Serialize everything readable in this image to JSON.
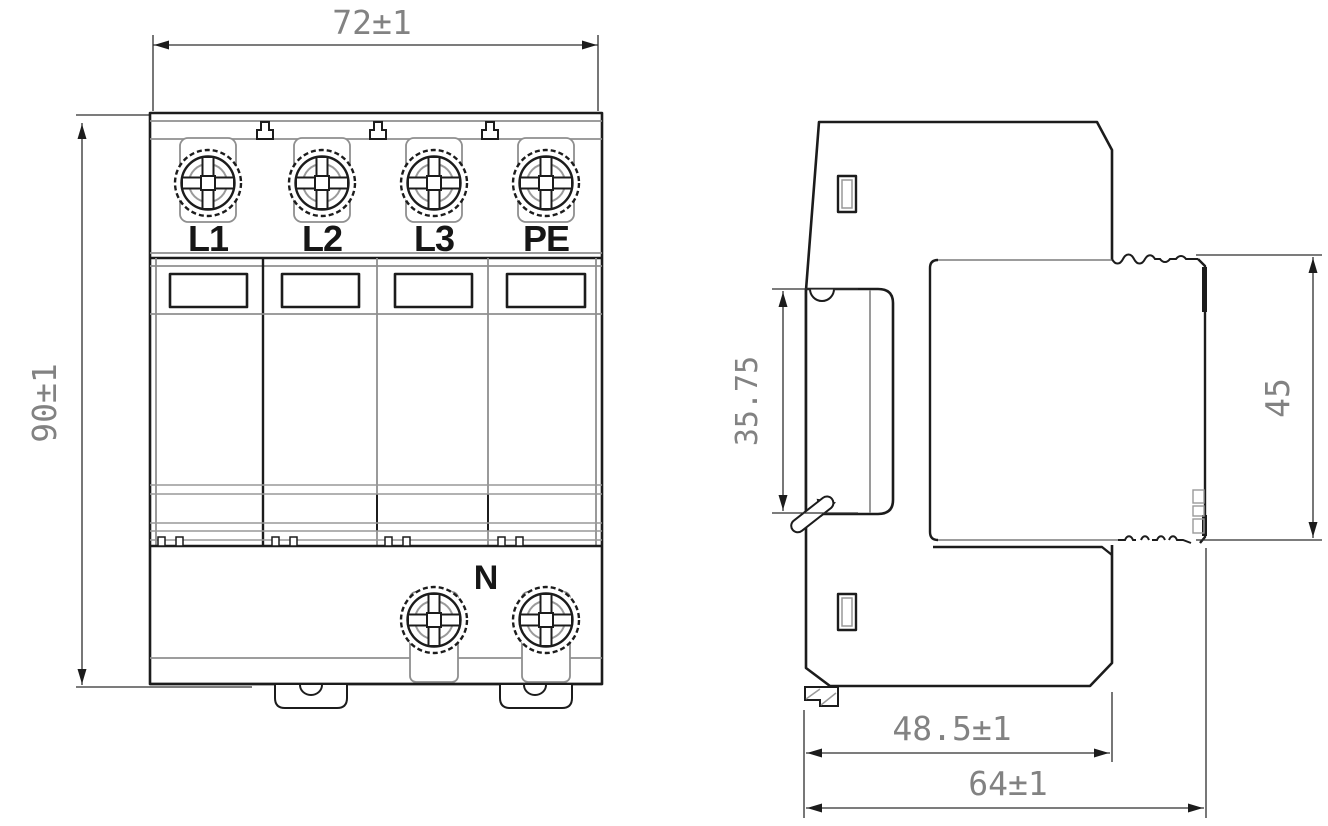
{
  "colors": {
    "ink": "#1c1c1c",
    "secondary_line": "#8f8f8f",
    "dimension_text": "#828282",
    "background": "#ffffff"
  },
  "front_view": {
    "dim_width_label": "72±1",
    "dim_height_label": "90±1",
    "terminals": [
      "L1",
      "L2",
      "L3",
      "PE"
    ],
    "neutral_label": "N"
  },
  "side_view": {
    "dim_rail_recess_label": "35.75",
    "dim_module_height_label": "45",
    "dim_base_depth_label": "48.5±1",
    "dim_overall_depth_label": "64±1"
  }
}
